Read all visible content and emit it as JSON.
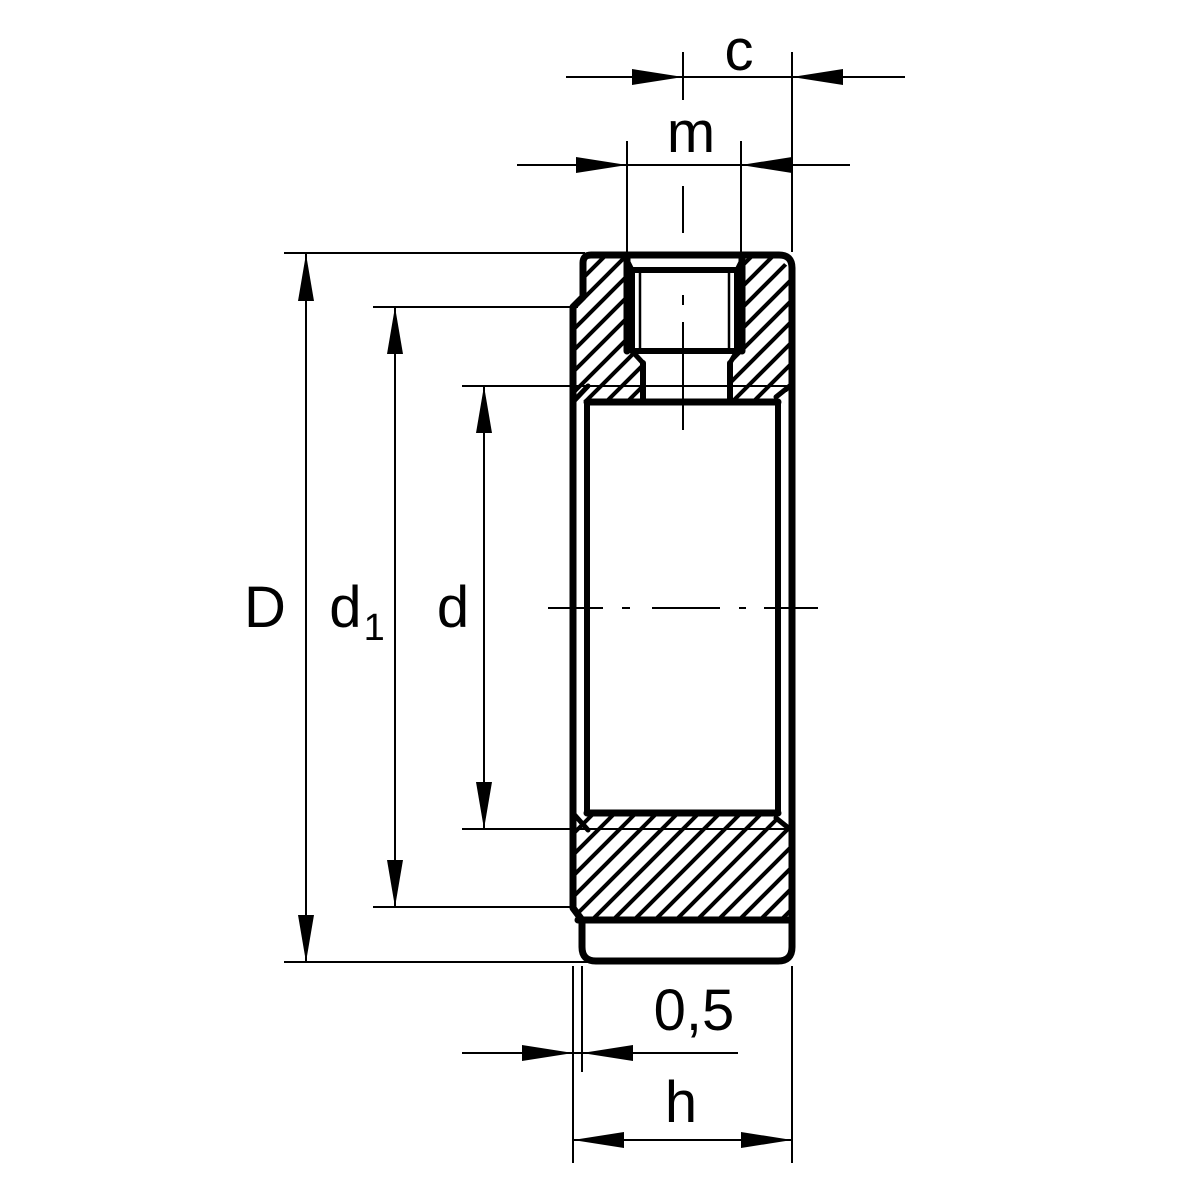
{
  "drawing": {
    "colors": {
      "line": "#000000",
      "background": "#ffffff"
    },
    "dimension_labels": {
      "c": "c",
      "m": "m",
      "D": "D",
      "d1_base": "d",
      "d1_sub": "1",
      "d": "d",
      "offset": "0,5",
      "h": "h"
    }
  }
}
